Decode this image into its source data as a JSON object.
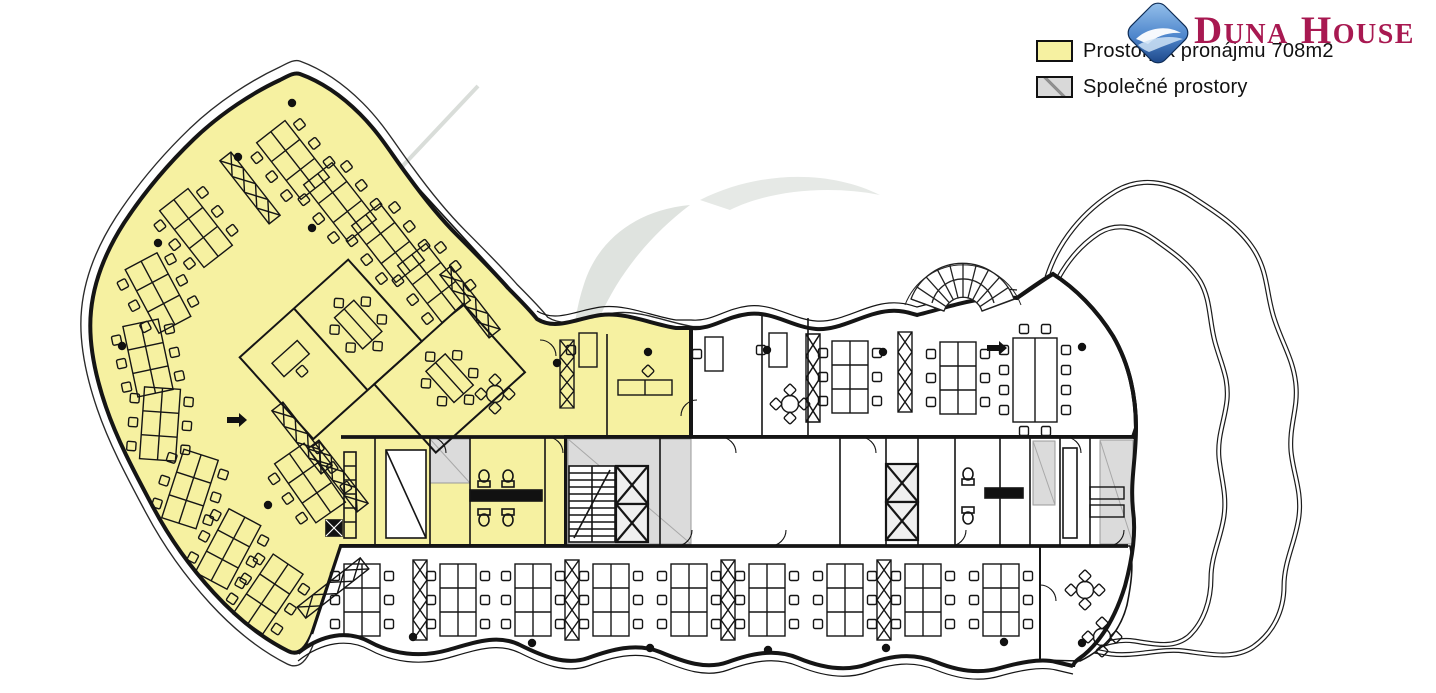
{
  "brand": {
    "name": "Duna House",
    "wordmark": {
      "w1i": "D",
      "w1r": "UNA",
      "w2i": "H",
      "w2r": "OUSE"
    },
    "wordmark_color": "#A81951",
    "diamond_colors": {
      "light": "#9CC6EE",
      "mid": "#4E86CC",
      "dark": "#173F80"
    }
  },
  "legend": {
    "items": [
      {
        "id": "rentable",
        "label": "Prostory k pronájmu 708m2",
        "swatch_color": "#F6F1A1",
        "hatched": false
      },
      {
        "id": "common",
        "label": "Společné prostory",
        "swatch_color": "#D9D9D9",
        "hatched": true
      }
    ]
  },
  "plan": {
    "rentable_area_m2": "708m2",
    "rentable_fill": "#F6F1A1",
    "common_fill": "#DBDBDB",
    "wall_color": "#151515",
    "watermark_color": "#DFE3DF"
  }
}
